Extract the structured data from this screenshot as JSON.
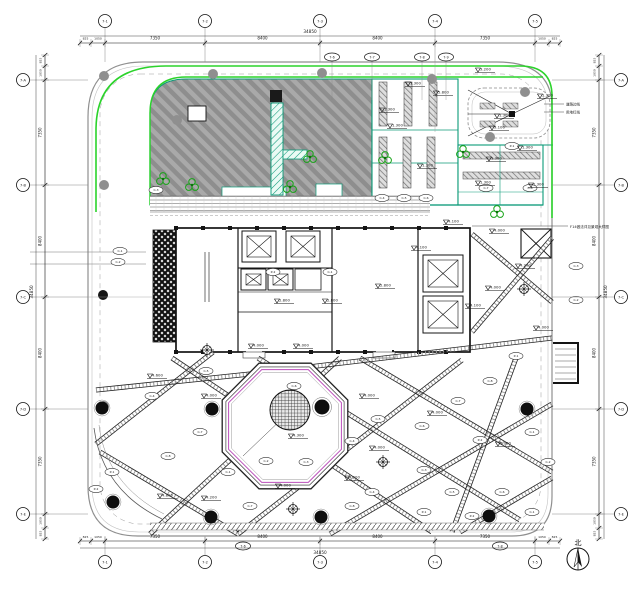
{
  "colors": {
    "green": "#2bd32b",
    "teal": "#0b9a78",
    "magenta": "#bb4fbb",
    "hatch_dark": "#8e8e8e",
    "hatch_light": "#a9a9a9",
    "line_black": "#141414",
    "gray": "#8f8f8f"
  },
  "axes": {
    "top_labels": [
      "7-1",
      "7-2",
      "7-3",
      "7-4",
      "7-5"
    ],
    "bottom_labels": [
      "7-1",
      "7-2",
      "7-3",
      "7-4",
      "7-5"
    ],
    "left_labels": [
      "7-A",
      "7-B",
      "7-C",
      "7-D",
      "7-E"
    ],
    "right_labels": [
      "7-A",
      "7-B",
      "7-C",
      "7-D",
      "7-E"
    ],
    "sub_top_labels": [
      "7-6",
      "7-7",
      "7-8",
      "7-9"
    ],
    "sub_bottom_labels": [
      "7-6",
      "7-8"
    ]
  },
  "dimensions": {
    "segment_labels": [
      "825",
      "1050",
      "7350",
      "8400",
      "8400",
      "7350",
      "1050",
      "825"
    ],
    "total_label": "34850"
  },
  "north_label": "北",
  "annotations": {
    "leader_note": "F14做法详见景观大样图",
    "margin_notes": [
      "道路边线",
      "用地红线"
    ]
  },
  "octagon": {
    "cx": 285,
    "cy": 426,
    "r": 68,
    "level": "4.300"
  },
  "spot_levels": [
    {
      "x": 408,
      "y": 86,
      "v": "1.300"
    },
    {
      "x": 436,
      "y": 95,
      "v": "5.800"
    },
    {
      "x": 382,
      "y": 112,
      "v": "1.300"
    },
    {
      "x": 390,
      "y": 128,
      "v": "1.300"
    },
    {
      "x": 497,
      "y": 118,
      "v": "1.300"
    },
    {
      "x": 492,
      "y": 130,
      "v": "3.100"
    },
    {
      "x": 540,
      "y": 98,
      "v": "1.300"
    },
    {
      "x": 478,
      "y": 72,
      "v": "3.200"
    },
    {
      "x": 420,
      "y": 168,
      "v": "1.300"
    },
    {
      "x": 489,
      "y": 161,
      "v": "1.300"
    },
    {
      "x": 520,
      "y": 150,
      "v": "1.300"
    },
    {
      "x": 478,
      "y": 185,
      "v": "1.300"
    },
    {
      "x": 531,
      "y": 187,
      "v": "1.300"
    },
    {
      "x": 251,
      "y": 348,
      "v": "4.000"
    },
    {
      "x": 296,
      "y": 348,
      "v": "4.000"
    },
    {
      "x": 446,
      "y": 224,
      "v": "4.100"
    },
    {
      "x": 414,
      "y": 250,
      "v": "4.100"
    },
    {
      "x": 468,
      "y": 308,
      "v": "4.100"
    },
    {
      "x": 378,
      "y": 288,
      "v": "2.800"
    },
    {
      "x": 277,
      "y": 303,
      "v": "2.800"
    },
    {
      "x": 325,
      "y": 303,
      "v": "2.800"
    },
    {
      "x": 150,
      "y": 378,
      "v": "4.600"
    },
    {
      "x": 204,
      "y": 398,
      "v": "4.000"
    },
    {
      "x": 492,
      "y": 233,
      "v": "4.000"
    },
    {
      "x": 488,
      "y": 290,
      "v": "4.000"
    },
    {
      "x": 518,
      "y": 268,
      "v": "4.200"
    },
    {
      "x": 278,
      "y": 488,
      "v": "4.000"
    },
    {
      "x": 204,
      "y": 500,
      "v": "4.200"
    },
    {
      "x": 160,
      "y": 498,
      "v": "4.800"
    },
    {
      "x": 347,
      "y": 480,
      "v": "4.200"
    },
    {
      "x": 372,
      "y": 450,
      "v": "4.000"
    },
    {
      "x": 430,
      "y": 415,
      "v": "4.000"
    },
    {
      "x": 498,
      "y": 446,
      "v": "4.000"
    },
    {
      "x": 536,
      "y": 330,
      "v": "4.000"
    },
    {
      "x": 362,
      "y": 398,
      "v": "4.000"
    }
  ],
  "plant_tags": [
    {
      "x": 120,
      "y": 251
    },
    {
      "x": 118,
      "y": 262
    },
    {
      "x": 156,
      "y": 190
    },
    {
      "x": 152,
      "y": 396
    },
    {
      "x": 206,
      "y": 371
    },
    {
      "x": 294,
      "y": 386
    },
    {
      "x": 200,
      "y": 432
    },
    {
      "x": 168,
      "y": 456
    },
    {
      "x": 112,
      "y": 472
    },
    {
      "x": 96,
      "y": 489
    },
    {
      "x": 228,
      "y": 472
    },
    {
      "x": 266,
      "y": 461
    },
    {
      "x": 306,
      "y": 462
    },
    {
      "x": 352,
      "y": 441
    },
    {
      "x": 378,
      "y": 419
    },
    {
      "x": 422,
      "y": 426
    },
    {
      "x": 458,
      "y": 401
    },
    {
      "x": 490,
      "y": 381
    },
    {
      "x": 516,
      "y": 356
    },
    {
      "x": 480,
      "y": 440
    },
    {
      "x": 532,
      "y": 432
    },
    {
      "x": 548,
      "y": 462
    },
    {
      "x": 424,
      "y": 470
    },
    {
      "x": 372,
      "y": 492
    },
    {
      "x": 452,
      "y": 492
    },
    {
      "x": 502,
      "y": 492
    },
    {
      "x": 250,
      "y": 506
    },
    {
      "x": 352,
      "y": 506
    },
    {
      "x": 424,
      "y": 512
    },
    {
      "x": 472,
      "y": 516
    },
    {
      "x": 532,
      "y": 512
    },
    {
      "x": 576,
      "y": 300
    },
    {
      "x": 576,
      "y": 266
    },
    {
      "x": 382,
      "y": 198
    },
    {
      "x": 404,
      "y": 198
    },
    {
      "x": 426,
      "y": 198
    },
    {
      "x": 486,
      "y": 188
    },
    {
      "x": 530,
      "y": 188
    },
    {
      "x": 512,
      "y": 146
    },
    {
      "x": 273,
      "y": 272
    },
    {
      "x": 330,
      "y": 272
    }
  ],
  "plant_codes": [
    "C-1",
    "C-2",
    "C-3",
    "C-4",
    "C-5",
    "C-6",
    "C-7",
    "C-8",
    "P-1",
    "P-2"
  ],
  "dots": [
    {
      "x": 104,
      "y": 76,
      "t": "g"
    },
    {
      "x": 104,
      "y": 185,
      "t": "g"
    },
    {
      "x": 103,
      "y": 295,
      "t": "b"
    },
    {
      "x": 104,
      "y": 406,
      "t": "g"
    },
    {
      "x": 213,
      "y": 74,
      "t": "g"
    },
    {
      "x": 322,
      "y": 73,
      "t": "g"
    },
    {
      "x": 432,
      "y": 79,
      "t": "g"
    },
    {
      "x": 490,
      "y": 137,
      "t": "g"
    },
    {
      "x": 525,
      "y": 92,
      "t": "g"
    },
    {
      "x": 177,
      "y": 120,
      "t": "g"
    }
  ],
  "trees": [
    {
      "x": 102,
      "y": 408
    },
    {
      "x": 212,
      "y": 409
    },
    {
      "x": 113,
      "y": 502
    },
    {
      "x": 211,
      "y": 517
    },
    {
      "x": 321,
      "y": 517
    },
    {
      "x": 489,
      "y": 516
    },
    {
      "x": 527,
      "y": 409
    }
  ],
  "tree_crosses": [
    {
      "x": 524,
      "y": 289
    },
    {
      "x": 293,
      "y": 509
    },
    {
      "x": 207,
      "y": 350
    },
    {
      "x": 383,
      "y": 462
    }
  ],
  "tree_clusters": [
    {
      "x": 192,
      "y": 185
    },
    {
      "x": 290,
      "y": 187
    },
    {
      "x": 310,
      "y": 157
    },
    {
      "x": 385,
      "y": 158
    },
    {
      "x": 463,
      "y": 152
    },
    {
      "x": 497,
      "y": 212
    },
    {
      "x": 163,
      "y": 179
    }
  ],
  "path_segments": [
    [
      96,
      444,
      213,
      352
    ],
    [
      100,
      452,
      238,
      534
    ],
    [
      150,
      534,
      340,
      358
    ],
    [
      172,
      358,
      432,
      532
    ],
    [
      238,
      534,
      462,
      360
    ],
    [
      258,
      358,
      520,
      520
    ],
    [
      330,
      534,
      552,
      404
    ],
    [
      360,
      358,
      552,
      472
    ],
    [
      460,
      532,
      552,
      478
    ],
    [
      96,
      390,
      250,
      374
    ],
    [
      250,
      374,
      552,
      338
    ],
    [
      516,
      358,
      452,
      532
    ],
    [
      472,
      234,
      552,
      302
    ],
    [
      472,
      332,
      552,
      238
    ]
  ]
}
